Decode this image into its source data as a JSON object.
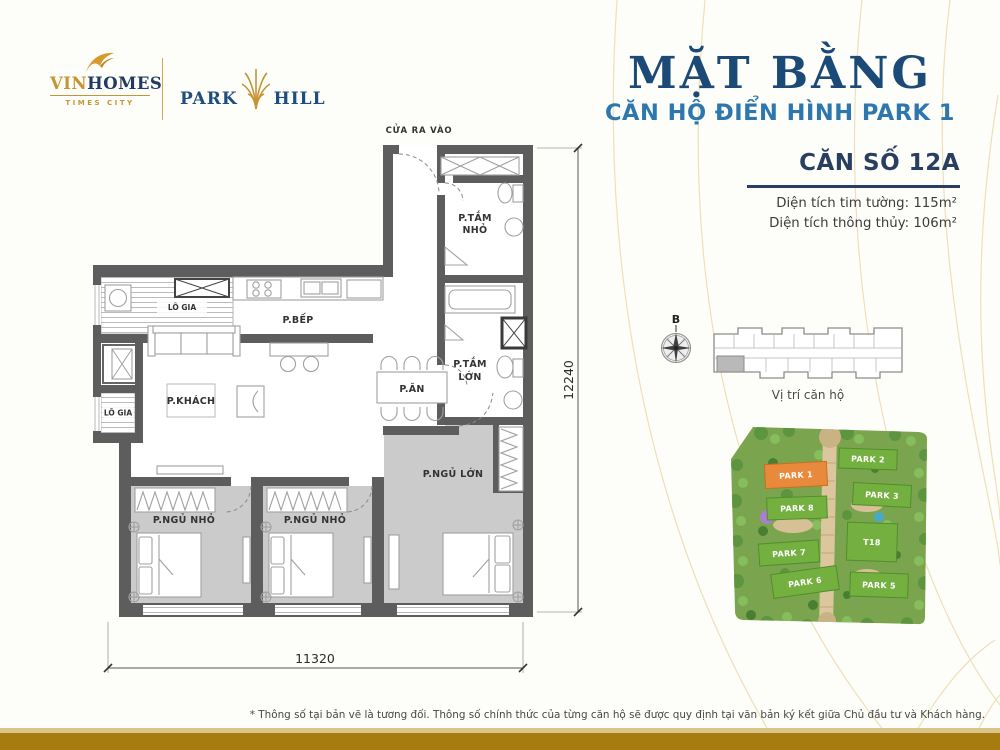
{
  "brand": {
    "vinhomes_vin": "VIN",
    "vinhomes_homes": "HOMES",
    "vinhomes_sub": "TIMES CITY",
    "park": "PARK",
    "hill": "HILL"
  },
  "header": {
    "title": "MẶT BẰNG",
    "subtitle": "CĂN HỘ ĐIỂN HÌNH PARK 1"
  },
  "unit": {
    "number": "CĂN SỐ 12A",
    "area_gross": "Diện tích tim tường: 115m²",
    "area_net": "Diện tích thông thủy: 106m²"
  },
  "plan": {
    "entrance": "CỬA RA VÀO",
    "rooms": {
      "loggia_top": "LÔ GIA",
      "loggia_left": "LÔ GIA",
      "kitchen": "P.BẾP",
      "living": "P.KHÁCH",
      "dining": "P.ĂN",
      "bath_small_l1": "P.TẮM",
      "bath_small_l2": "NHỎ",
      "bath_big_l1": "P.TẮM",
      "bath_big_l2": "LỚN",
      "bedroom_small_1": "P.NGỦ NHỎ",
      "bedroom_small_2": "P.NGỦ NHỎ",
      "bedroom_master": "P.NGỦ LỚN"
    },
    "dim_height": "12240",
    "dim_width": "11320"
  },
  "location": {
    "north": "B",
    "caption": "Vị trí căn hộ"
  },
  "sitemap": {
    "park1": "PARK 1",
    "park2": "PARK 2",
    "park3": "PARK 3",
    "park5": "PARK 5",
    "park6": "PARK 6",
    "park7": "PARK 7",
    "park8": "PARK 8",
    "t18": "T18"
  },
  "footnote": "* Thông số tại bản vẽ là tương đối. Thông số chính thức của từng căn hộ sẽ được quy định tại văn bản ký kết giữa Chủ đầu tư và Khách hàng.",
  "colors": {
    "accent_gold": "#c79433",
    "navy": "#1c4a77",
    "blue": "#2e77ae",
    "wall_gray": "#5d5d5d",
    "bedroom_floor": "#cbcbcb",
    "park_green": "#74b03f",
    "park_orange": "#e8893b",
    "bar_gold": "#a67c10",
    "bar_light": "#d9c48a"
  }
}
